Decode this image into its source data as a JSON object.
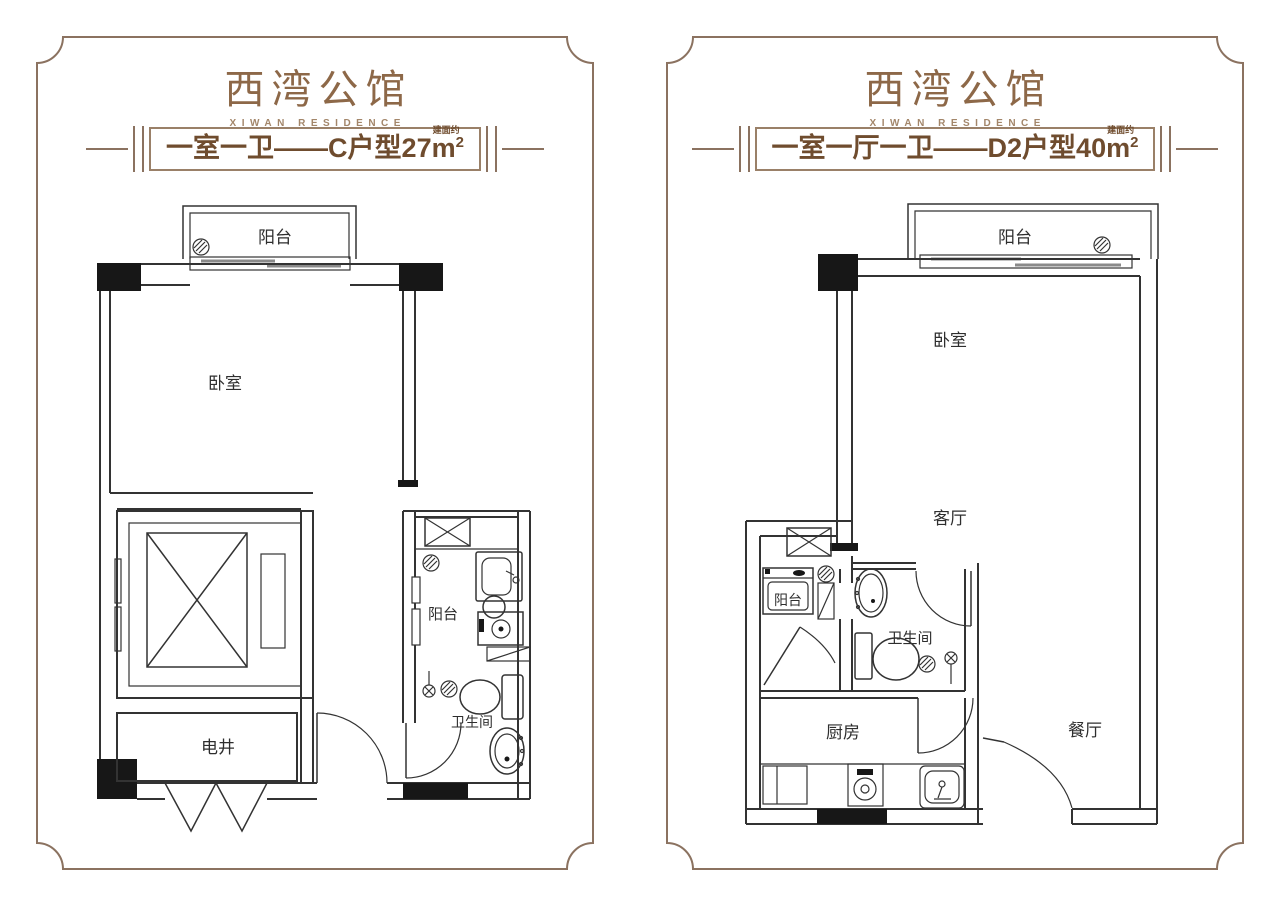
{
  "brand": {
    "title": "西湾公馆",
    "subtitle": "XIWAN RESIDENCE"
  },
  "colors": {
    "frame": "#8b7260",
    "brand_title": "#8d6848",
    "brand_subtitle": "#a3866a",
    "banner_text": "#6f4c2e",
    "banner_border": "#9a8068",
    "plan_line": "#333333",
    "column_fill": "#171717",
    "window_glass": "#8a8a8a"
  },
  "plans": [
    {
      "banner_label": "一室一卫——C户型",
      "area_value": "27",
      "area_note": "建面约",
      "unit_base": "m",
      "unit_exp": "2",
      "rooms": {
        "balcony": "阳台",
        "bedroom": "卧室",
        "utility_shaft": "电井",
        "service_balcony": "阳台",
        "bathroom": "卫生间"
      }
    },
    {
      "banner_label": "一室一厅一卫——D2户型",
      "area_value": "40",
      "area_note": "建面约",
      "unit_base": "m",
      "unit_exp": "2",
      "rooms": {
        "balcony": "阳台",
        "bedroom": "卧室",
        "living": "客厅",
        "service_balcony": "阳台",
        "bathroom": "卫生间",
        "kitchen": "厨房",
        "dining": "餐厅"
      }
    }
  ]
}
